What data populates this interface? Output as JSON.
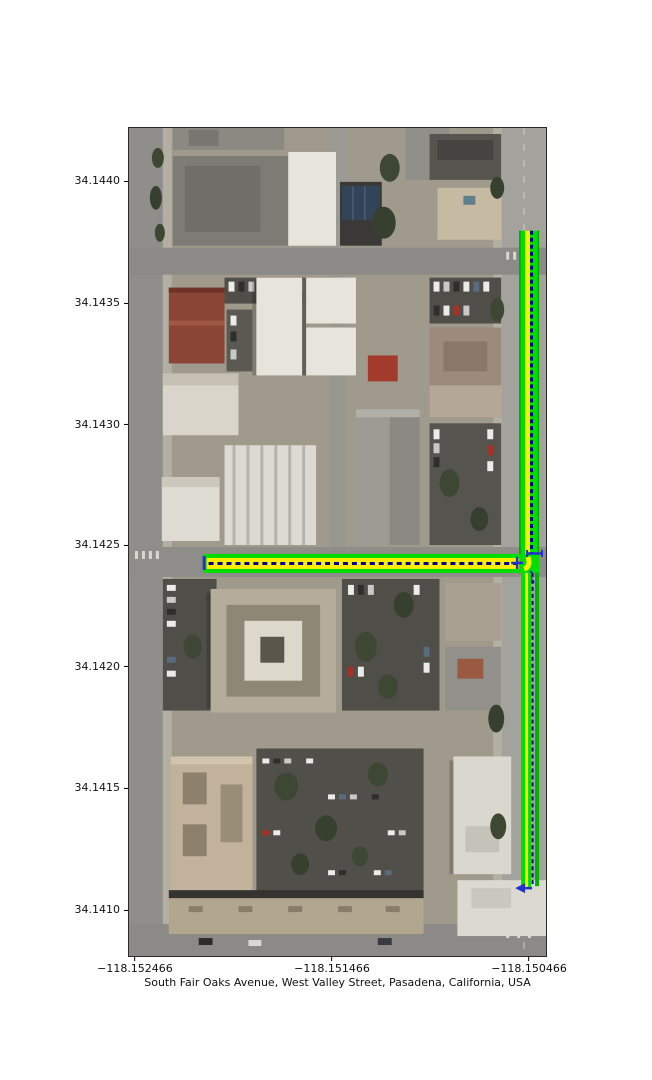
{
  "figure": {
    "width": 652,
    "height": 1080,
    "background": "#ffffff"
  },
  "map": {
    "xlabel": "South Fair Oaks Avenue, West Valley Street, Pasadena, California, USA",
    "xticks": [
      {
        "label": "−118.152466",
        "pos_pct": 1.43
      },
      {
        "label": "−118.151466",
        "pos_pct": 48.69
      },
      {
        "label": "−118.150466",
        "pos_pct": 95.94
      }
    ],
    "yticks": [
      {
        "label": "34.1440",
        "pos_pct": 6.45
      },
      {
        "label": "34.1435",
        "pos_pct": 21.14
      },
      {
        "label": "34.1430",
        "pos_pct": 35.84
      },
      {
        "label": "34.1425",
        "pos_pct": 50.36
      },
      {
        "label": "34.1420",
        "pos_pct": 65.06
      },
      {
        "label": "34.1415",
        "pos_pct": 79.76
      },
      {
        "label": "34.1410",
        "pos_pct": 94.46
      }
    ]
  },
  "colors": {
    "route_green": "#00dd00",
    "route_green_dark": "#00b400",
    "route_yellow": "#ffee00",
    "edge_navy": "#000099",
    "arrow_blue": "#2233cc"
  },
  "chart_data": {
    "type": "map",
    "map_kind": "satellite aerial imagery with street-route overlay",
    "title": "South Fair Oaks Avenue, West Valley Street, Pasadena, California, USA",
    "location": "Pasadena, California, USA",
    "streets_highlighted": [
      "South Fair Oaks Avenue",
      "West Valley Street"
    ],
    "lon_axis": {
      "ticks": [
        -118.152466,
        -118.151466,
        -118.150466
      ],
      "range": [
        -118.152496,
        -118.15038
      ]
    },
    "lat_axis": {
      "ticks": [
        34.144,
        34.1435,
        34.143,
        34.1425,
        34.142,
        34.1415,
        34.141
      ],
      "range": [
        34.140811,
        34.144219
      ]
    },
    "routes": [
      {
        "name": "South Fair Oaks Avenue segment",
        "orientation": "vertical",
        "lon": -118.15046,
        "lat_from": 34.1438,
        "lat_to": 34.1411,
        "style": "green band with yellow core and dashed navy centerline"
      },
      {
        "name": "West Valley Street segment",
        "orientation": "horizontal",
        "lat": 34.14244,
        "lon_from": -118.15225,
        "lon_to": -118.15046,
        "style": "green band with yellow core and dashed navy centerline"
      }
    ],
    "junction": {
      "lat": 34.14244,
      "lon": -118.15046,
      "markers": "small blue directional arrows at graph nodes"
    },
    "grid": false,
    "legend": false
  }
}
